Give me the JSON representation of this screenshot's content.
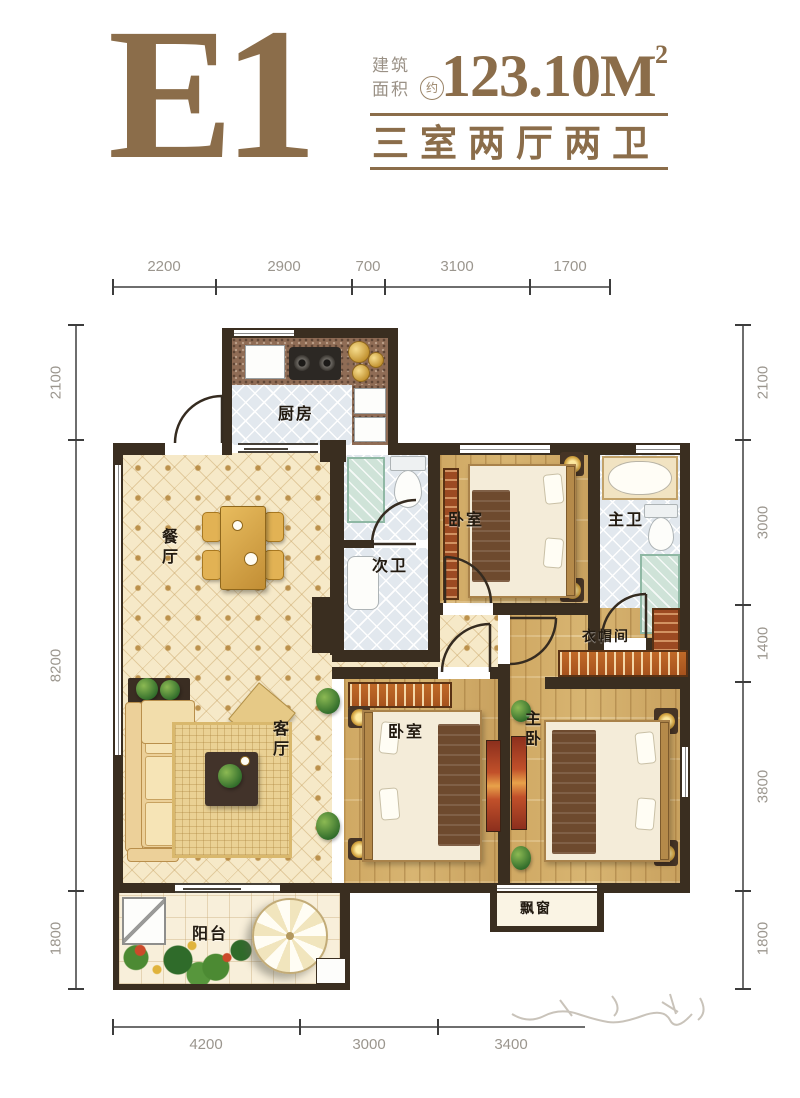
{
  "header": {
    "unit_name": "E1",
    "area_label_line1": "建筑",
    "area_label_line2": "面积",
    "area_approx": "约",
    "area_value": "123.10M",
    "area_superscript": "2",
    "layout_text": "三室两厅两卫",
    "accent_color": "#8b6d4a"
  },
  "rooms": {
    "kitchen": "厨房",
    "dining": "餐厅",
    "living": "客厅",
    "second_bath": "次卫",
    "bedroom_top": "卧室",
    "master_bath": "主卫",
    "closet": "衣帽间",
    "bedroom_mid": "卧室",
    "master_bedroom": "主卧",
    "balcony": "阳台",
    "bay_window": "飘窗"
  },
  "dimensions": {
    "top": [
      "2200",
      "2900",
      "700",
      "3100",
      "1700"
    ],
    "bottom": [
      "4200",
      "3000",
      "3400"
    ],
    "left": [
      "2100",
      "8200",
      "1800"
    ],
    "right": [
      "2100",
      "3000",
      "1400",
      "3800",
      "1800"
    ]
  },
  "colors": {
    "accent": "#8b6d4a",
    "wall": "#3a2e20"
  }
}
